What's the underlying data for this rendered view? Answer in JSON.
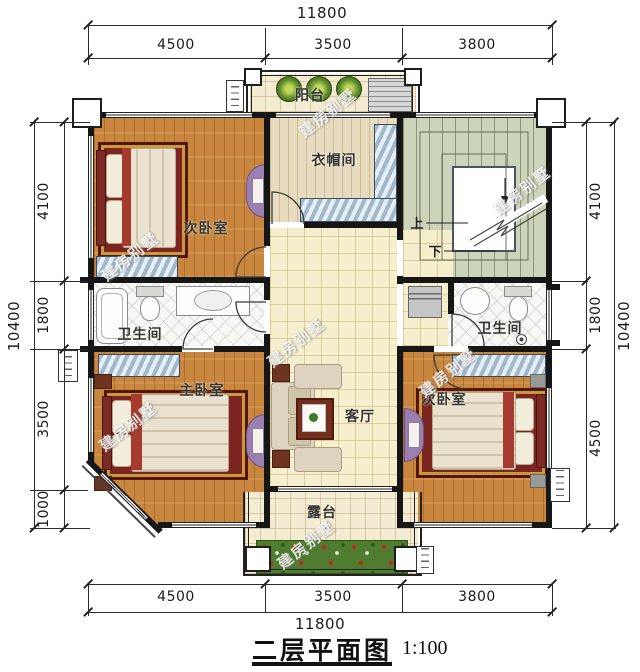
{
  "title": {
    "text": "二层平面图",
    "scale": "1:100"
  },
  "watermark": "建房别墅",
  "dimensions": {
    "top": {
      "total": "11800",
      "segments": [
        "4500",
        "3500",
        "3800"
      ]
    },
    "bottom": {
      "total": "11800",
      "segments": [
        "4500",
        "3500",
        "3800"
      ]
    },
    "left": {
      "total": "10400",
      "segments": [
        "4100",
        "1800",
        "3500",
        "1000"
      ]
    },
    "right": {
      "total": "10400",
      "segments": [
        "4100",
        "1800",
        "4500"
      ]
    }
  },
  "rooms": {
    "balcony": "阳台",
    "cloakroom": "衣帽间",
    "bedroom_top_left": "次卧室",
    "bathroom_left": "卫生间",
    "master_bedroom": "主卧室",
    "living_room": "客厅",
    "bedroom_bottom_right": "次卧室",
    "bathroom_right": "卫生间",
    "terrace": "露台"
  },
  "stairs": {
    "up": "上",
    "down": "下"
  },
  "colors": {
    "wall": "#161616",
    "wood_floor": "#c8863e",
    "hall_floor": "#f6efcd",
    "stair_floor": "#ccd5b9",
    "closet_blue": "#9fb8cc",
    "bed_rug_red": "#7c241f",
    "dresser_purple": "#9a7fb0"
  }
}
